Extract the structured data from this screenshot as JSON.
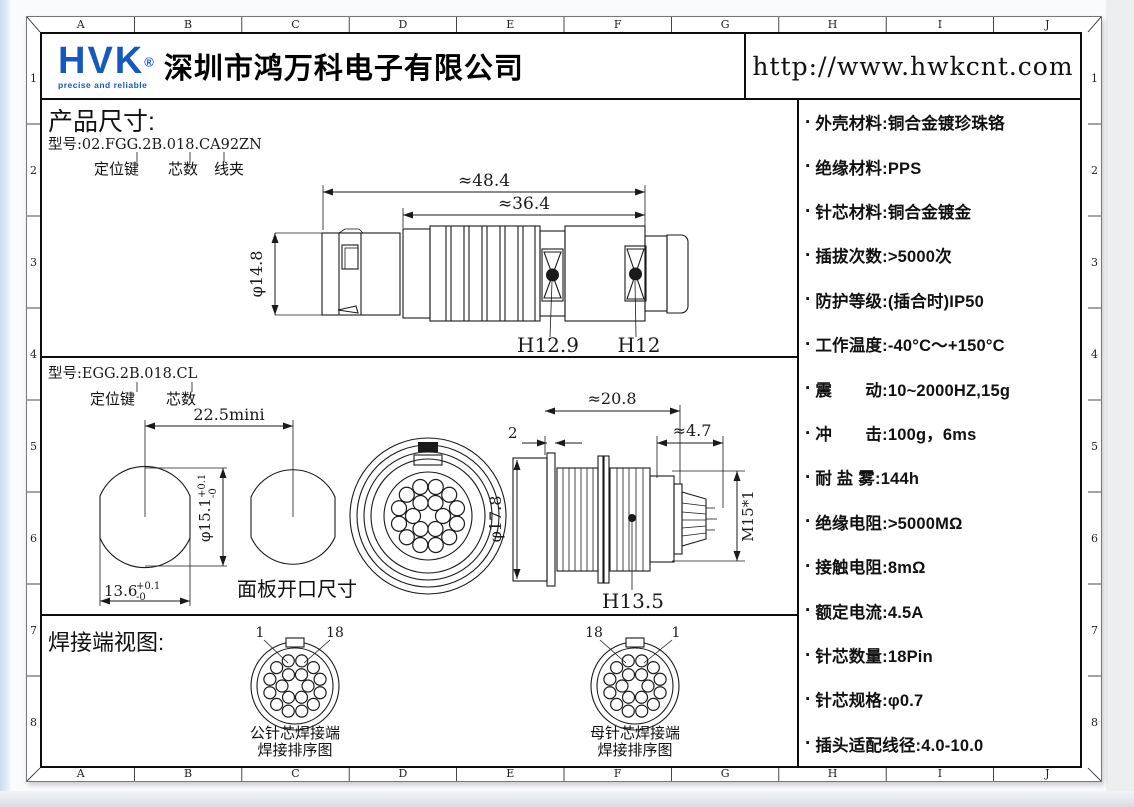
{
  "grid": {
    "cols": [
      "A",
      "B",
      "C",
      "D",
      "E",
      "F",
      "G",
      "H",
      "I",
      "J"
    ],
    "rows": [
      "1",
      "2",
      "3",
      "4",
      "5",
      "6",
      "7",
      "8"
    ]
  },
  "header": {
    "logo_text": "HVK",
    "logo_reg": "®",
    "logo_tagline": "precise and reliable",
    "logo_color": "#1558c0",
    "company": "深圳市鸿万科电子有限公司",
    "url": "http://www.hwkcnt.com"
  },
  "section1": {
    "title": "产品尺寸:",
    "model": "型号:02.FGG.2B.018.CA92ZN",
    "callout_key": "定位键",
    "callout_cores": "芯数",
    "callout_clamp": "线夹",
    "dim_total": "≈48.4",
    "dim_front": "≈36.4",
    "dim_dia": "φ14.8",
    "hex_label_1": "H12.9",
    "hex_label_2": "H12"
  },
  "section2": {
    "model": "型号:EGG.2B.018.CL",
    "callout_key": "定位键",
    "callout_cores": "芯数",
    "dim_pitch": "22.5mini",
    "dim_panel_dia": "φ15.1",
    "tol_up": "+0.1",
    "tol_dn": "-0",
    "dim_panel_w": "13.6",
    "tol_up2": "+0.1",
    "tol_dn2": "-0",
    "panel_label": "面板开口尺寸",
    "dim_len": "≈20.8",
    "dim_plate": "2",
    "dim_tail": "≈4.7",
    "dim_dia": "φ17.8",
    "thread_label": "M15*1",
    "hex_label": "H13.5"
  },
  "section3": {
    "title": "焊接端视图:",
    "pin_count": 18,
    "male": {
      "label_left": "1",
      "label_right": "18",
      "caption1": "公针芯焊接端",
      "caption2": "焊接排序图"
    },
    "female": {
      "label_left": "18",
      "label_right": "1",
      "caption1": "母针芯焊接端",
      "caption2": "焊接排序图"
    }
  },
  "specs": {
    "bullet": "·",
    "items": [
      "外壳材料:铜合金镀珍珠铬",
      "绝缘材料:PPS",
      "针芯材料:铜合金镀金",
      "插拔次数:>5000次",
      "防护等级:(插合时)IP50",
      "工作温度:-40°C～+150°C",
      "震　　动:10~2000HZ,15g",
      "冲　　击:100g，6ms",
      "耐 盐 雾:144h",
      "绝缘电阻:>5000MΩ",
      "接触电阻:8mΩ",
      "额定电流:4.5A",
      "针芯数量:18Pin",
      "针芯规格:φ0.7",
      "插头适配线径:4.0-10.0"
    ]
  }
}
